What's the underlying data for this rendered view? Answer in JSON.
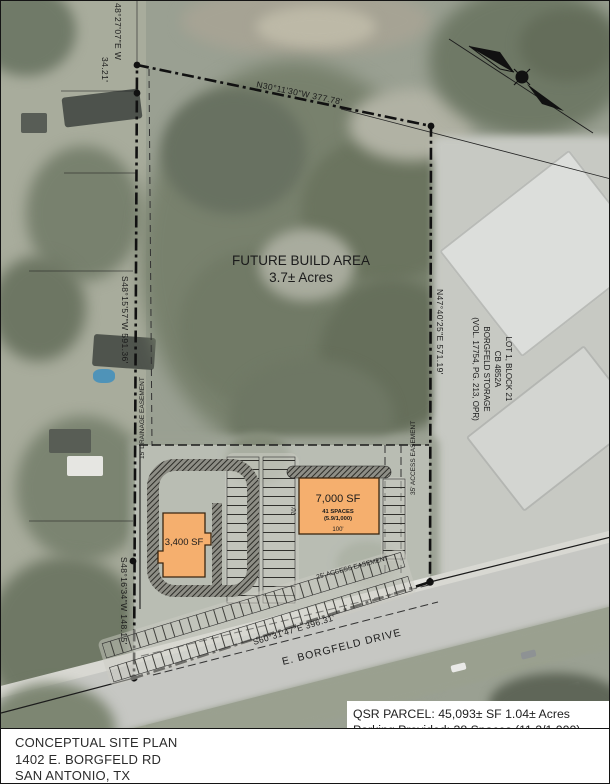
{
  "title_block": {
    "line1": "CONCEPTUAL SITE PLAN",
    "line2": "1402 E. BORGFELD RD",
    "line3": "SAN ANTONIO, TX"
  },
  "parcel_stats": {
    "qsr_line1": "QSR PARCEL: 45,093± SF  1.04± Acres",
    "qsr_line2": "Parking Provided: 38 Spaces (11.2/1,000)",
    "retail_line1": "RETAIL PARCEL:  42,042± SF  0.97± Acres",
    "retail_line2": "Parking Provided:  38 Spaces (5/1,000)"
  },
  "site": {
    "future_area": {
      "line1": "FUTURE BUILD AREA",
      "line2": "3.7± Acres"
    },
    "bearings": {
      "north": "N30°11'30\"W   377.78'",
      "northwest": "48°27'07\"E  W",
      "northwest_len": "34.21'",
      "west": "S48°15'57\"W   591.36'",
      "east": "N47°40'25\"E   571.19'",
      "southwest": "S48°16'34\"W  148.15'",
      "south": "S60°31'47\"E   396.31'"
    },
    "adjacent_lot": {
      "line1": "LOT 1, BLOCK 21",
      "line2": "CB 4852A",
      "line3": "BORGFELD STORAGE",
      "line4": "(VOL. 17754, PG. 213, OPR)"
    },
    "easements": {
      "drainage": "15' DRAINAGE EASEMENT",
      "access35": "35' ACCESS EASEMENT",
      "access25": "25' ACCESS EASEMENT"
    },
    "road": "E. BORGFELD DRIVE",
    "qsr_building": {
      "area": "7,000 SF",
      "spaces": "41 SPACES",
      "ratio": "(5.9/1,000)",
      "width": "100'",
      "depth": "70'"
    },
    "retail_building": {
      "area": "3,400 SF"
    }
  },
  "colors": {
    "building_fill": "#F5AF6E",
    "building_stroke": "#5a3414",
    "boundary": "#111111",
    "aerial_base": "#9aa092",
    "label_red": "#8a3c22"
  }
}
